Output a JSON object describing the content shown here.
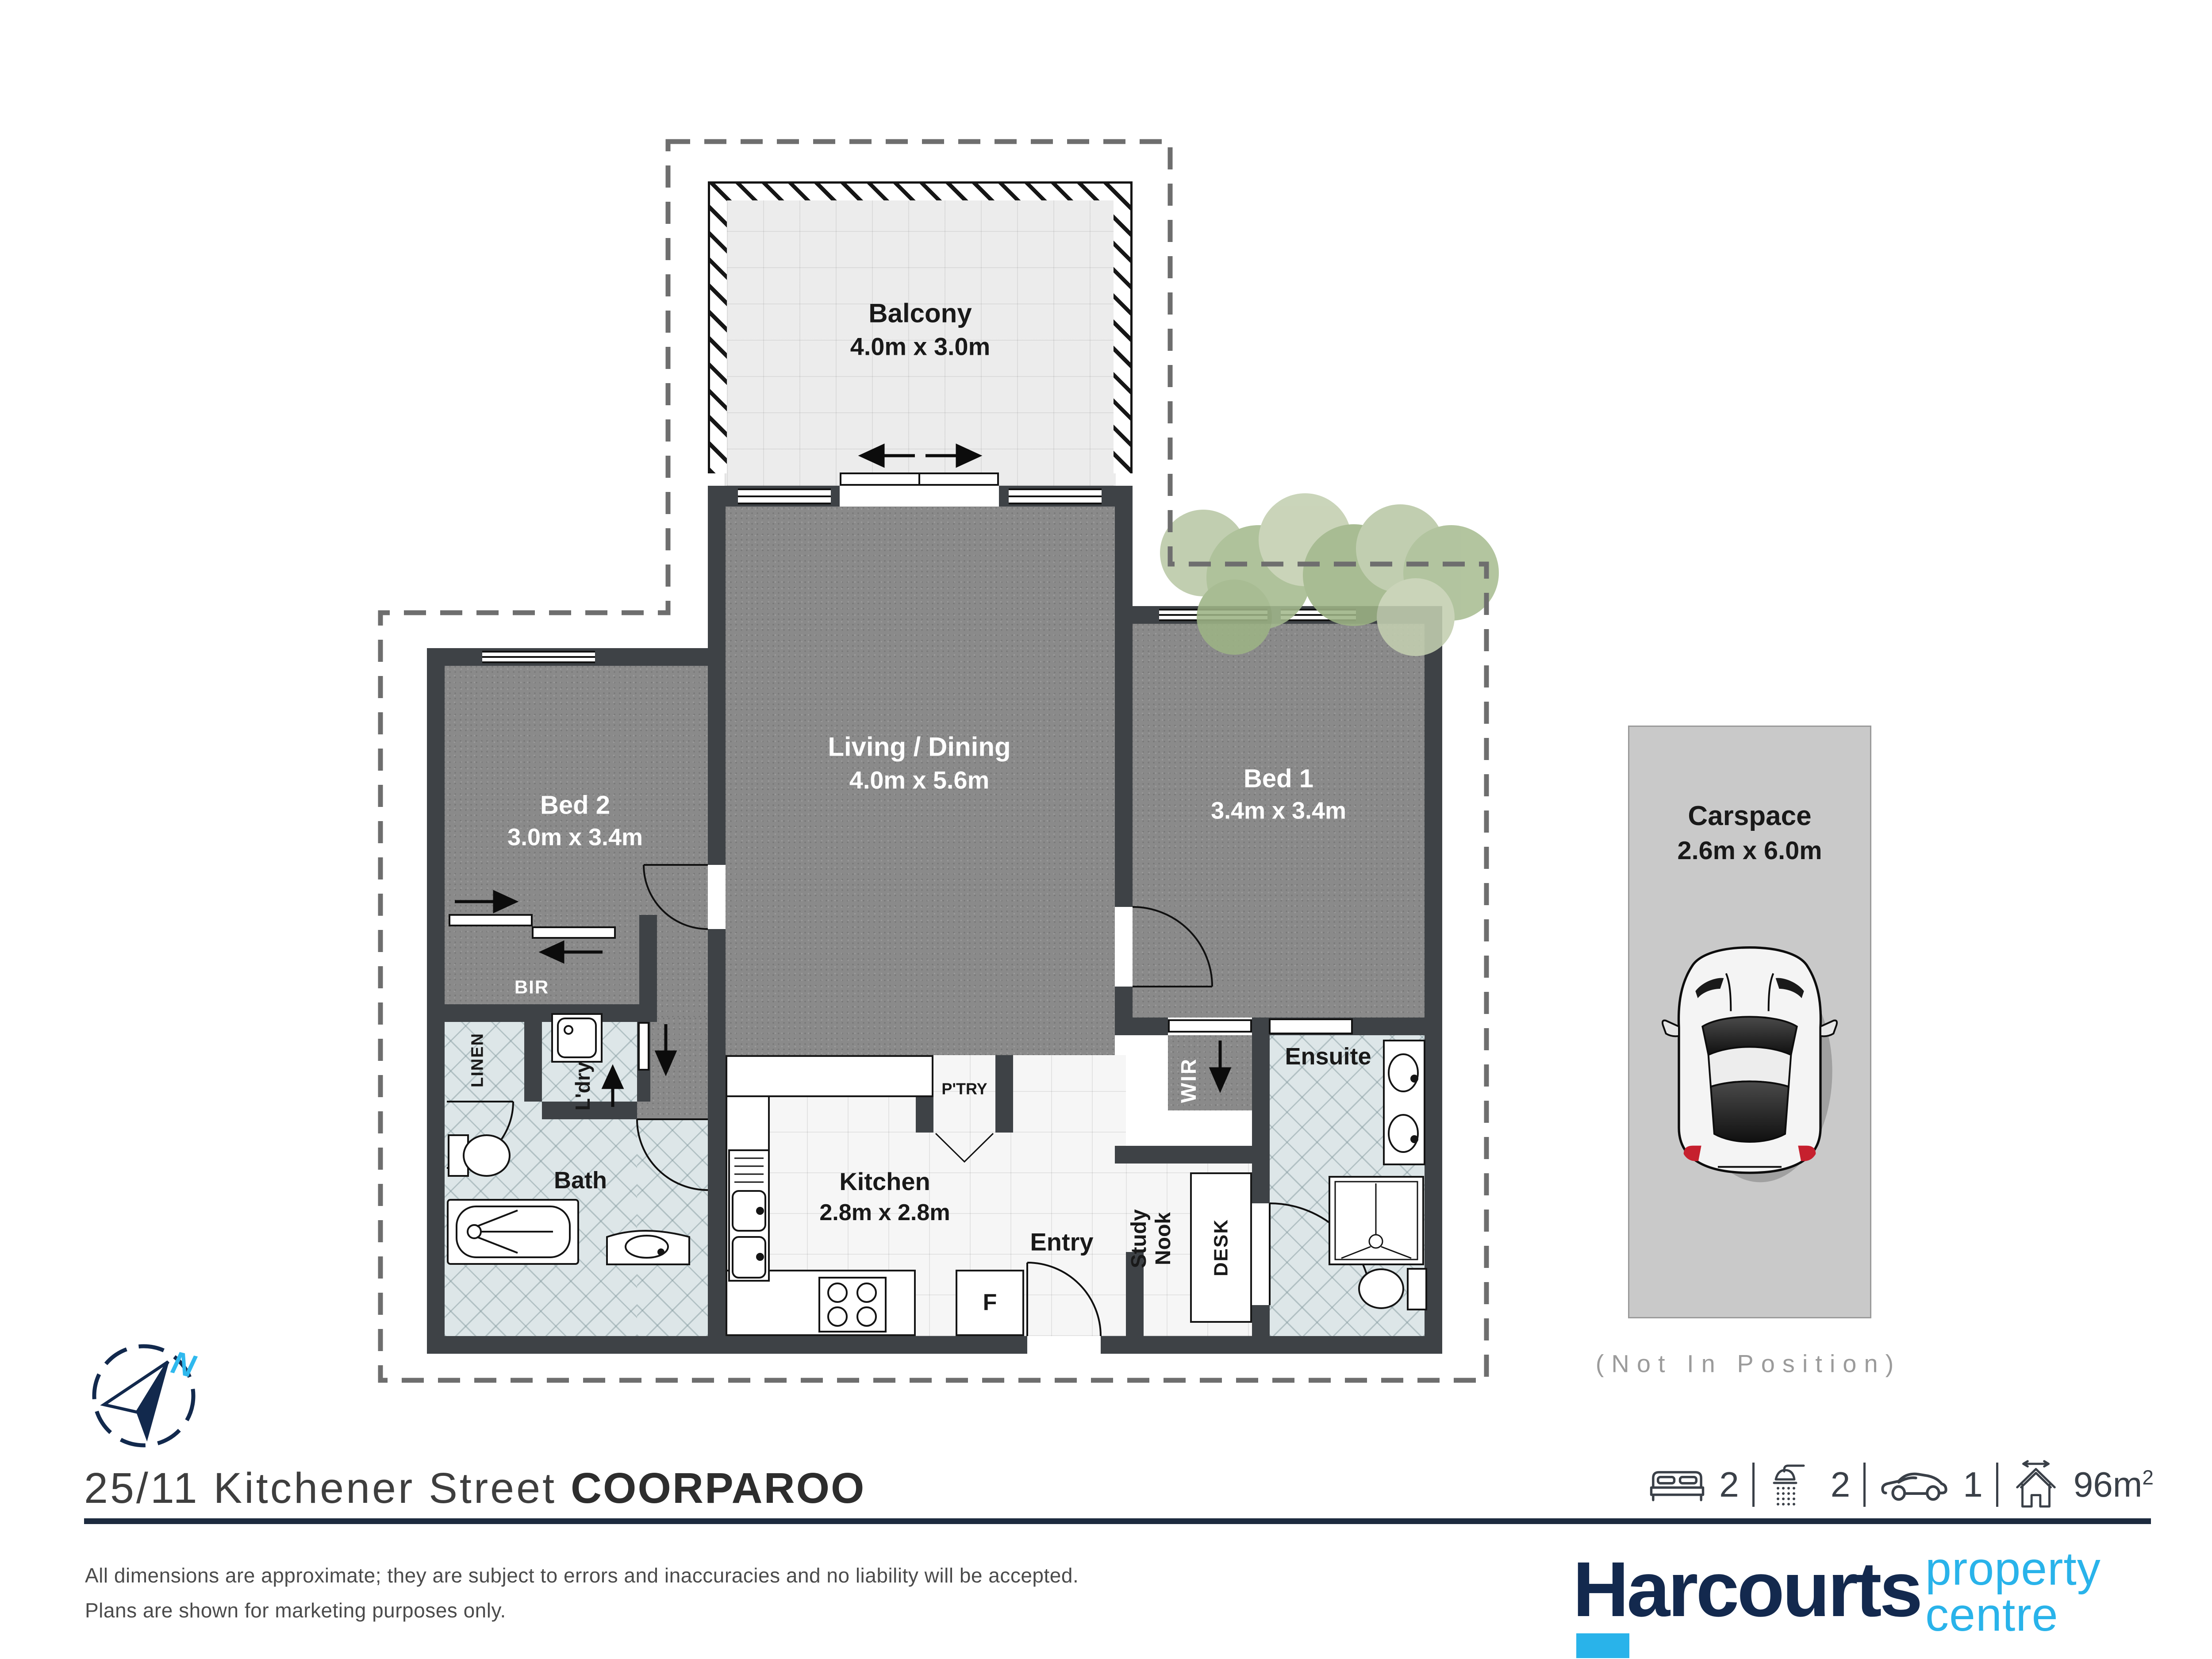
{
  "address": {
    "street": "25/11 Kitchener Street",
    "suburb": "COORPAROO"
  },
  "rooms": {
    "balcony": {
      "name": "Balcony",
      "dims": "4.0m x 3.0m"
    },
    "living": {
      "name": "Living / Dining",
      "dims": "4.0m x 5.6m"
    },
    "bed2": {
      "name": "Bed 2",
      "dims": "3.0m x 3.4m"
    },
    "bed1": {
      "name": "Bed 1",
      "dims": "3.4m x 3.4m"
    },
    "kitchen": {
      "name": "Kitchen",
      "dims": "2.8m x 2.8m"
    },
    "bath": {
      "name": "Bath"
    },
    "ensuite": {
      "name": "Ensuite"
    },
    "entry": {
      "name": "Entry"
    },
    "study": {
      "name": "Study\nNook"
    },
    "wir": {
      "name": "WIR"
    },
    "bir": {
      "name": "BIR"
    },
    "linen": {
      "name": "LINEN"
    },
    "laundry": {
      "name": "L'dry"
    },
    "pantry": {
      "name": "P'TRY"
    },
    "desk": {
      "name": "DESK"
    },
    "fridge": {
      "name": "F"
    }
  },
  "carspace": {
    "name": "Carspace",
    "dims": "2.6m x 6.0m",
    "note": "(Not In Position)"
  },
  "compass": {
    "north": "N"
  },
  "summary": {
    "beds": "2",
    "showers": "2",
    "cars": "1",
    "area": "96m",
    "area_exp": "2"
  },
  "disclaimer": {
    "line1": "All dimensions are approximate; they are subject to errors and inaccuracies and no liability will be accepted.",
    "line2": "Plans are shown for marketing purposes only."
  },
  "brand": {
    "name": "Harcourts",
    "tag1": "property",
    "tag2": "centre",
    "navy": "#13294e",
    "cyan": "#29b3ea"
  },
  "palette": {
    "wall": "#3e4246",
    "carpet": "#8a8a8a",
    "wet_tile": "#dde6e8",
    "boundary_dash": "#6e6e6e",
    "carspace_fill": "#c9c9c9"
  }
}
